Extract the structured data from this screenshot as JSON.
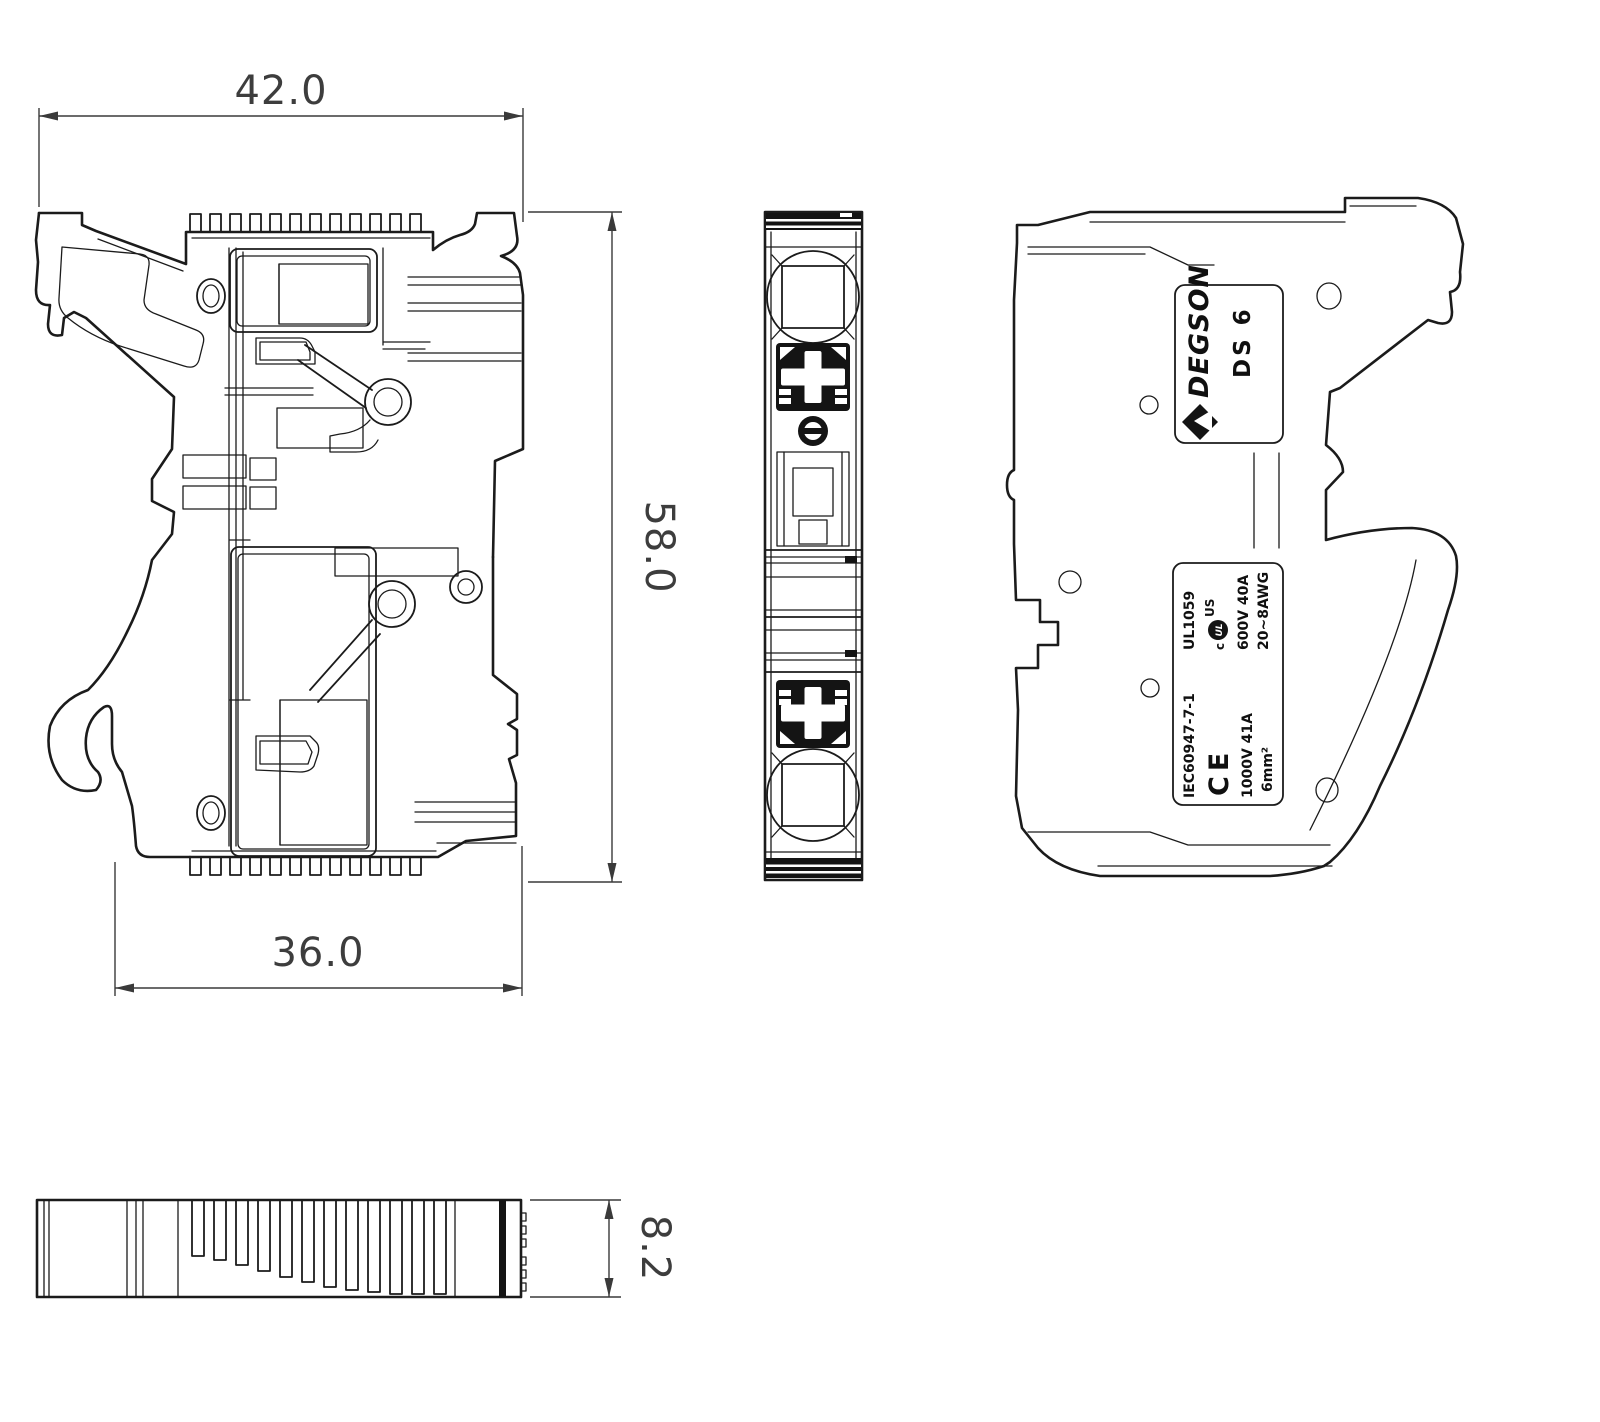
{
  "colors": {
    "background": "#ffffff",
    "line": "#1b1b1b",
    "dimension": "#3a3a3a"
  },
  "dimensions": {
    "top_width": "42.0",
    "height": "58.0",
    "bottom_width": "36.0",
    "thickness": "8.2"
  },
  "brand_label": {
    "brand": "DEGSON",
    "model": "DS 6"
  },
  "spec_label": {
    "ul": {
      "standard": "UL1059",
      "mark_prefix": "c",
      "mark": "UL",
      "mark_suffix": "US",
      "rating": "600V 40A",
      "wire_range": "20~8AWG"
    },
    "iec": {
      "standard": "IEC60947-7-1",
      "mark": "CE",
      "rating": "1000V 41A",
      "wire_size": "6mm²"
    }
  }
}
